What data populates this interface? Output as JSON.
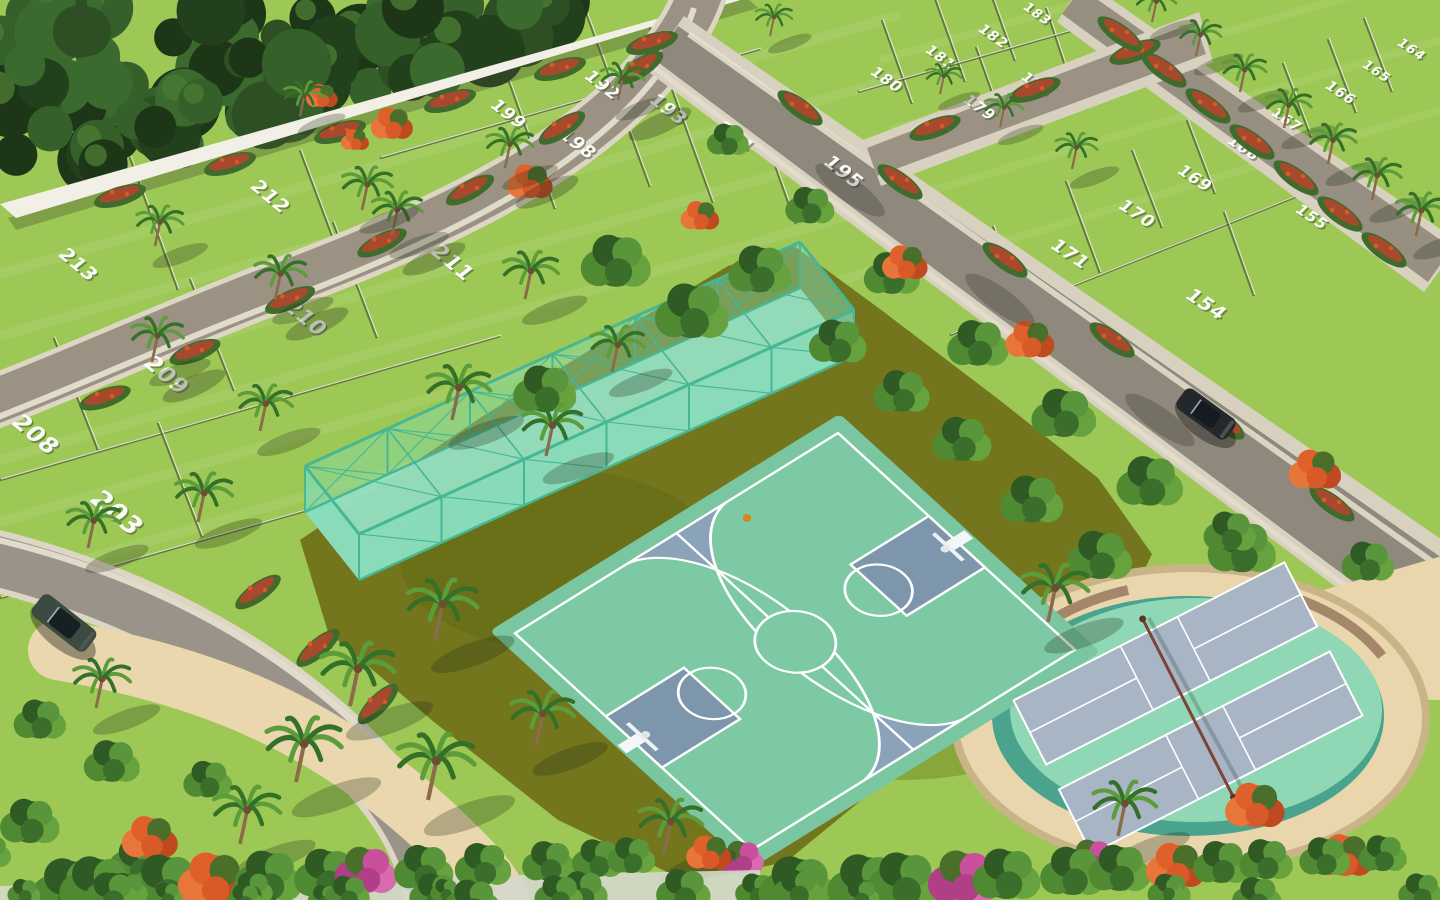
{
  "scene": {
    "name": "residential-plot-layout-aerial-render",
    "alt": "Aerial 3D render of a plotted land development: numbered green plots separated by palm-lined roads, a white boundary wall beside dense forest, a blue and mint basketball court with a fenced practice cage, and an oval sand terrace with two pickleball courts surrounded by tropical flowering landscaping."
  },
  "plots": {
    "numbers": [
      {
        "label": "192",
        "x": 583,
        "y": 77,
        "size": 17,
        "rot": 38
      },
      {
        "label": "193",
        "x": 648,
        "y": 101,
        "size": 18,
        "rot": 38
      },
      {
        "label": "194",
        "x": 714,
        "y": 128,
        "size": 18,
        "rot": 38
      },
      {
        "label": "195",
        "x": 822,
        "y": 163,
        "size": 19,
        "rot": 38
      },
      {
        "label": "199",
        "x": 489,
        "y": 106,
        "size": 17,
        "rot": 38
      },
      {
        "label": "198",
        "x": 557,
        "y": 135,
        "size": 18,
        "rot": 38
      },
      {
        "label": "213",
        "x": 57,
        "y": 255,
        "size": 19,
        "rot": 40
      },
      {
        "label": "212",
        "x": 249,
        "y": 187,
        "size": 19,
        "rot": 40
      },
      {
        "label": "211",
        "x": 429,
        "y": 252,
        "size": 21,
        "rot": 40
      },
      {
        "label": "210",
        "x": 282,
        "y": 307,
        "size": 21,
        "rot": 40
      },
      {
        "label": "209",
        "x": 142,
        "y": 364,
        "size": 22,
        "rot": 40
      },
      {
        "label": "208",
        "x": 10,
        "y": 423,
        "size": 23,
        "rot": 40
      },
      {
        "label": "203",
        "x": 88,
        "y": 500,
        "size": 26,
        "rot": 40
      },
      {
        "label": "183",
        "x": 1022,
        "y": 8,
        "size": 13,
        "rot": 36
      },
      {
        "label": "182",
        "x": 977,
        "y": 30,
        "size": 14,
        "rot": 36
      },
      {
        "label": "181",
        "x": 924,
        "y": 51,
        "size": 14,
        "rot": 36
      },
      {
        "label": "180",
        "x": 869,
        "y": 73,
        "size": 15,
        "rot": 36
      },
      {
        "label": "178",
        "x": 1020,
        "y": 78,
        "size": 14,
        "rot": 36
      },
      {
        "label": "179",
        "x": 962,
        "y": 101,
        "size": 15,
        "rot": 36
      },
      {
        "label": "164",
        "x": 1396,
        "y": 44,
        "size": 13,
        "rot": 34
      },
      {
        "label": "165",
        "x": 1361,
        "y": 66,
        "size": 13,
        "rot": 34
      },
      {
        "label": "166",
        "x": 1324,
        "y": 87,
        "size": 14,
        "rot": 34
      },
      {
        "label": "167",
        "x": 1270,
        "y": 114,
        "size": 14,
        "rot": 34
      },
      {
        "label": "168",
        "x": 1226,
        "y": 142,
        "size": 15,
        "rot": 34
      },
      {
        "label": "169",
        "x": 1176,
        "y": 172,
        "size": 16,
        "rot": 34
      },
      {
        "label": "170",
        "x": 1117,
        "y": 207,
        "size": 17,
        "rot": 34
      },
      {
        "label": "171",
        "x": 1049,
        "y": 247,
        "size": 18,
        "rot": 34
      },
      {
        "label": "154",
        "x": 1184,
        "y": 297,
        "size": 19,
        "rot": 34
      },
      {
        "label": "155",
        "x": 1294,
        "y": 211,
        "size": 15,
        "rot": 34
      }
    ]
  },
  "vehicles": [
    {
      "name": "suv-dark-green",
      "x": 64,
      "y": 623,
      "rot": 38,
      "len": 68,
      "wid": 27,
      "body": "#3c4a42"
    },
    {
      "name": "sedan-dark",
      "x": 1206,
      "y": 414,
      "rot": 36,
      "len": 62,
      "wid": 25,
      "body": "#23282c"
    }
  ],
  "objects": [
    {
      "name": "basketball",
      "x": 747,
      "y": 518,
      "r": 4,
      "color": "#d9831f"
    }
  ],
  "palette": {
    "grass": "#9dc855",
    "plotLine": "#4c5c33",
    "wall": "#f2efe6",
    "road": "#968f82",
    "curb": "#ddd6c4",
    "sidewalk": "#e9e3d3",
    "olive": "#73761c",
    "sand": "#e9d6ad",
    "courtGray": "#8ba3b9",
    "courtKey": "#7e96ac",
    "mint": "#7cc9a4",
    "cage": "#7fdcba",
    "cageFrame": "#46b693",
    "ovalMint": "#8fd7b5",
    "ovalTeal": "#49a38d",
    "pickle": "#a8b5c5",
    "forest": "#2c4a22",
    "palmGreen": "#3f7d2f",
    "flameOrange": "#d85a28",
    "pink": "#c9509c",
    "hedgeRed": "#b8432e"
  }
}
